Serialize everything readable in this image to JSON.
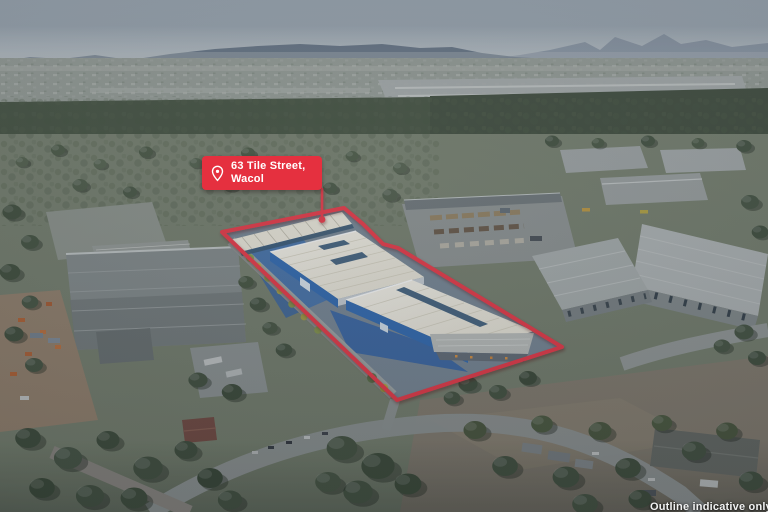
{
  "meta": {
    "kind": "aerial-property-photograph",
    "width": 768,
    "height": 512,
    "description": "Drone aerial photo of an industrial warehouse property outlined in red"
  },
  "marker": {
    "icon": "location-pin",
    "address_line1": "63 Tile Street,",
    "address_line2": "Wacol"
  },
  "footer": {
    "disclaimer": "Outline indicative only"
  },
  "colors": {
    "accent": "#e5303f",
    "roof": "#f1ede1",
    "skylight": "#3f5d79",
    "yard_blue": "#3e6ba5",
    "wall_blue": "#2b64ac",
    "sky_top": "#a7b3bd",
    "sky_horizon": "#cdd3d5",
    "mountain": "#56667b",
    "forest": "#44523c",
    "ground": "#7e8871",
    "road": "#9ba09d",
    "dirt": "#8e8473",
    "warehouse_grey": "#8f9594",
    "neighbor_roof": "#c3c7c6"
  }
}
